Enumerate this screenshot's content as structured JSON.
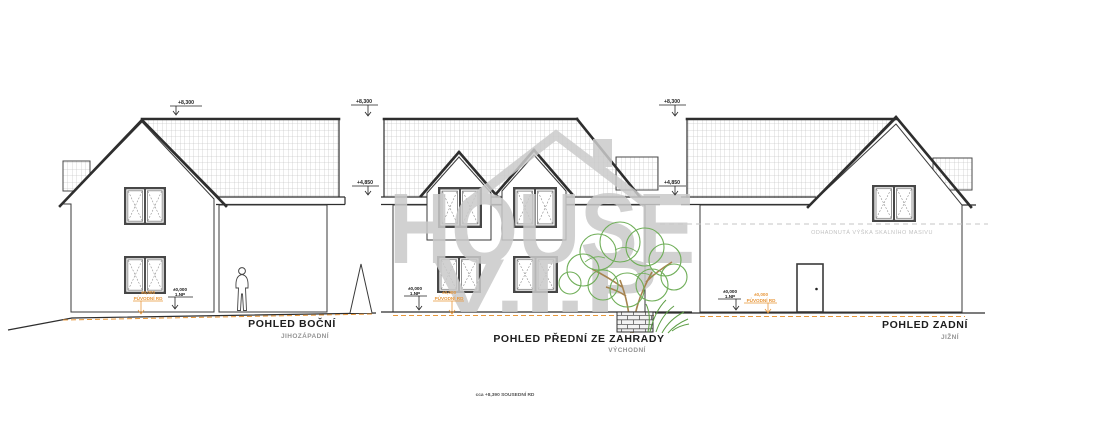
{
  "watermark": {
    "line1": "HOUSE",
    "line2": "V.I.P"
  },
  "elevations": [
    {
      "label": "POHLED BOČNÍ",
      "sublabel": "JIHOZÁPADNÍ"
    },
    {
      "label": "POHLED PŘEDNÍ ZE ZAHRADY",
      "sublabel": "VÝCHODNÍ"
    },
    {
      "label": "POHLED ZADNÍ",
      "sublabel": "JIŽNÍ"
    }
  ],
  "levels": {
    "ridge": "+8,300",
    "eave": "+4,850",
    "zero": "±0,000",
    "first_floor": "1.NP",
    "original_house": "PŮVODNÍ RD"
  },
  "notes": {
    "rock_massif": "ODHADNUTÁ VÝŠKA SKALNÍHO MASIVU",
    "footer": "cca +8,390 SOUSEDNÍ RD"
  },
  "colors": {
    "line": "#2e2e2e",
    "accent_orange": "#e8973a",
    "tree_green": "#6fae58",
    "trunk_brown": "#a6834f",
    "grass_green": "#5d9e45",
    "watermark_gray": "#cacaca",
    "rock_line_gray": "#c6c6c6",
    "sublabel_gray": "#949494"
  }
}
